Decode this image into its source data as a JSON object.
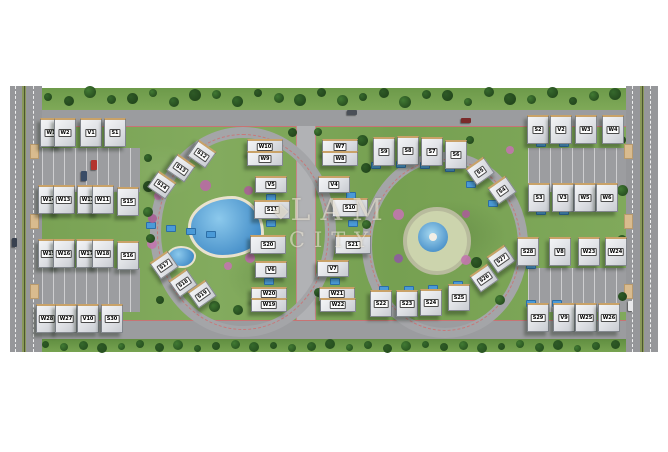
{
  "watermark": {
    "line1": "LAM",
    "line2": "CITY",
    "logo_glyph": "◆"
  },
  "site": {
    "description": "Aerial rendered master plan of a residential compound with W, V and S unit labels",
    "unit_series": [
      "W",
      "V",
      "S"
    ]
  },
  "colors": {
    "grass": "#79a254",
    "road": "#9b9c9f",
    "boulevard_median": "#89985a",
    "pool_blue": "#2e7bbd",
    "roof": "#e8e9ec",
    "roof_trim": "#c9a268",
    "road_edge_accent": "#d66666",
    "label_chip_bg": "#fdfdfd",
    "label_text": "#000000"
  },
  "buildings": [
    [
      "W1",
      50,
      131,
      20,
      26,
      0
    ],
    [
      "W2",
      64,
      131,
      20,
      26,
      0
    ],
    [
      "V1",
      90,
      131,
      20,
      26,
      0
    ],
    [
      "S1",
      114,
      131,
      20,
      26,
      0
    ],
    [
      "W14",
      48,
      198,
      20,
      26,
      0
    ],
    [
      "W13",
      63,
      198,
      20,
      26,
      0
    ],
    [
      "W12",
      87,
      198,
      20,
      26,
      0
    ],
    [
      "W11",
      102,
      198,
      20,
      26,
      0
    ],
    [
      "S15",
      127,
      200,
      20,
      26,
      0
    ],
    [
      "W15",
      48,
      252,
      20,
      26,
      0
    ],
    [
      "W16",
      63,
      252,
      20,
      26,
      0
    ],
    [
      "W17",
      86,
      252,
      20,
      26,
      0
    ],
    [
      "W18",
      102,
      252,
      20,
      26,
      0
    ],
    [
      "S16",
      127,
      254,
      20,
      26,
      0
    ],
    [
      "W28",
      46,
      317,
      20,
      26,
      0
    ],
    [
      "W27",
      65,
      317,
      20,
      26,
      0
    ],
    [
      "V10",
      87,
      317,
      20,
      26,
      0
    ],
    [
      "S30",
      111,
      317,
      20,
      26,
      0
    ],
    [
      "S12",
      201,
      152,
      20,
      17,
      35
    ],
    [
      "S13",
      180,
      166,
      20,
      17,
      35
    ],
    [
      "S14",
      161,
      183,
      20,
      17,
      35
    ],
    [
      "S17",
      163,
      263,
      20,
      17,
      -35
    ],
    [
      "S18",
      182,
      281,
      20,
      17,
      -35
    ],
    [
      "S19",
      201,
      292,
      20,
      17,
      -35
    ],
    [
      "W10",
      264,
      145,
      34,
      12,
      0
    ],
    [
      "W9",
      264,
      157,
      34,
      12,
      0
    ],
    [
      "V5",
      270,
      183,
      30,
      14,
      0
    ],
    [
      "S11",
      271,
      208,
      34,
      16,
      0
    ],
    [
      "S20",
      267,
      243,
      34,
      16,
      0
    ],
    [
      "V6",
      270,
      268,
      30,
      14,
      0
    ],
    [
      "W20",
      268,
      292,
      34,
      11,
      0
    ],
    [
      "W19",
      268,
      303,
      34,
      11,
      0
    ],
    [
      "W7",
      339,
      145,
      34,
      12,
      0
    ],
    [
      "W8",
      339,
      157,
      34,
      12,
      0
    ],
    [
      "V4",
      333,
      183,
      30,
      14,
      0
    ],
    [
      "S10",
      349,
      206,
      34,
      16,
      0
    ],
    [
      "S21",
      352,
      243,
      34,
      16,
      0
    ],
    [
      "V7",
      332,
      267,
      30,
      14,
      0
    ],
    [
      "W21",
      336,
      292,
      34,
      11,
      0
    ],
    [
      "W22",
      337,
      303,
      34,
      11,
      0
    ],
    [
      "S9",
      383,
      150,
      20,
      26,
      0
    ],
    [
      "S8",
      407,
      149,
      20,
      26,
      0
    ],
    [
      "S7",
      431,
      150,
      20,
      26,
      0
    ],
    [
      "S6",
      455,
      153,
      20,
      26,
      0
    ],
    [
      "S5",
      479,
      169,
      20,
      17,
      -35
    ],
    [
      "S4",
      501,
      188,
      20,
      17,
      -35
    ],
    [
      "S2",
      537,
      128,
      20,
      26,
      0
    ],
    [
      "V2",
      560,
      128,
      20,
      26,
      0
    ],
    [
      "W3",
      585,
      128,
      20,
      26,
      0
    ],
    [
      "W4",
      612,
      128,
      20,
      26,
      0
    ],
    [
      "S3",
      538,
      196,
      20,
      26,
      0
    ],
    [
      "V3",
      562,
      196,
      20,
      26,
      0
    ],
    [
      "W5",
      584,
      196,
      20,
      26,
      0
    ],
    [
      "W6",
      606,
      196,
      20,
      26,
      0
    ],
    [
      "S27",
      500,
      257,
      20,
      17,
      -35
    ],
    [
      "S28",
      527,
      250,
      20,
      26,
      0
    ],
    [
      "V8",
      559,
      250,
      20,
      26,
      0
    ],
    [
      "W23",
      588,
      250,
      20,
      26,
      0
    ],
    [
      "W24",
      615,
      250,
      20,
      26,
      0
    ],
    [
      "S22",
      380,
      302,
      20,
      24,
      0
    ],
    [
      "S23",
      406,
      302,
      20,
      24,
      0
    ],
    [
      "S24",
      430,
      301,
      20,
      24,
      0
    ],
    [
      "S25",
      458,
      296,
      20,
      24,
      0
    ],
    [
      "S26",
      483,
      276,
      20,
      17,
      -35
    ],
    [
      "S29",
      537,
      316,
      20,
      26,
      0
    ],
    [
      "V9",
      563,
      316,
      20,
      26,
      0
    ],
    [
      "W25",
      585,
      316,
      20,
      26,
      0
    ],
    [
      "W26",
      608,
      316,
      20,
      26,
      0
    ]
  ]
}
